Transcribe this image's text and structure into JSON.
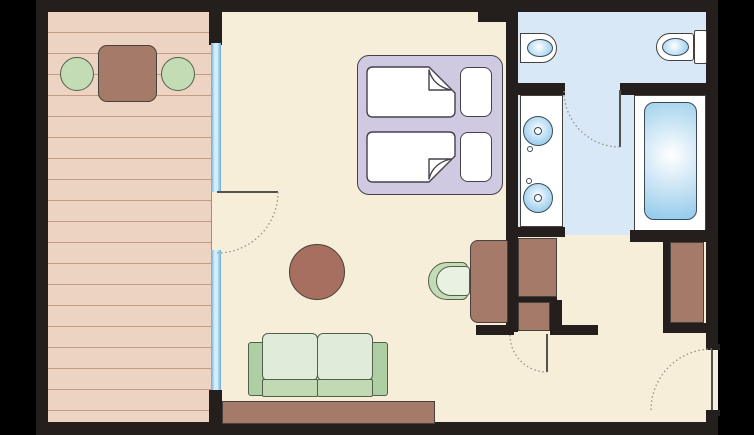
{
  "scene": "hotel-room-floor-plan",
  "palette": {
    "background": "#000000",
    "wall": "#241f1d",
    "room_floor": "#f6eed9",
    "balcony_floor": "#edd3c2",
    "plank_line": "#c59a87",
    "bath_floor": "#d8e8f6",
    "window_glass": "#a9d7f2",
    "window_frame": "#7ab4dc",
    "furniture_brown": "#a57a68",
    "round_table_brown": "#a66f60",
    "furniture_green": "#c3dcb5",
    "sofa_back_green": "#e0ecd9",
    "sofa_seat_green": "#c2dab4",
    "armrest_green": "#aecfa3",
    "chair_seat_green": "#e9f1e2",
    "bed_frame": "#cfc9e1",
    "bed_outline": "#45414b",
    "white": "#ffffff",
    "water_blue": "#8ec9ec",
    "fixture_outline": "#3d4a55",
    "outline_dark": "#46413d",
    "green_outline": "#51604b",
    "door_arc": "#9a9284",
    "door_leaf": "#55524d"
  },
  "rooms": [
    "balcony",
    "living-bedroom",
    "toilet-room",
    "bathroom-corridor",
    "bathtub-alcove",
    "entry-hall"
  ],
  "furniture": [
    "balcony-table",
    "balcony-chair-left",
    "balcony-chair-right",
    "double-bed",
    "pillows",
    "round-table",
    "sofa",
    "sideboard",
    "desk",
    "desk-chair",
    "closet-upper",
    "closet-lower",
    "wardrobe",
    "vanity-with-two-sinks",
    "bidet",
    "toilet",
    "bathtub"
  ],
  "doors": [
    "balcony-door",
    "wc-door",
    "closet-door",
    "entry-door"
  ],
  "window_count": 2
}
